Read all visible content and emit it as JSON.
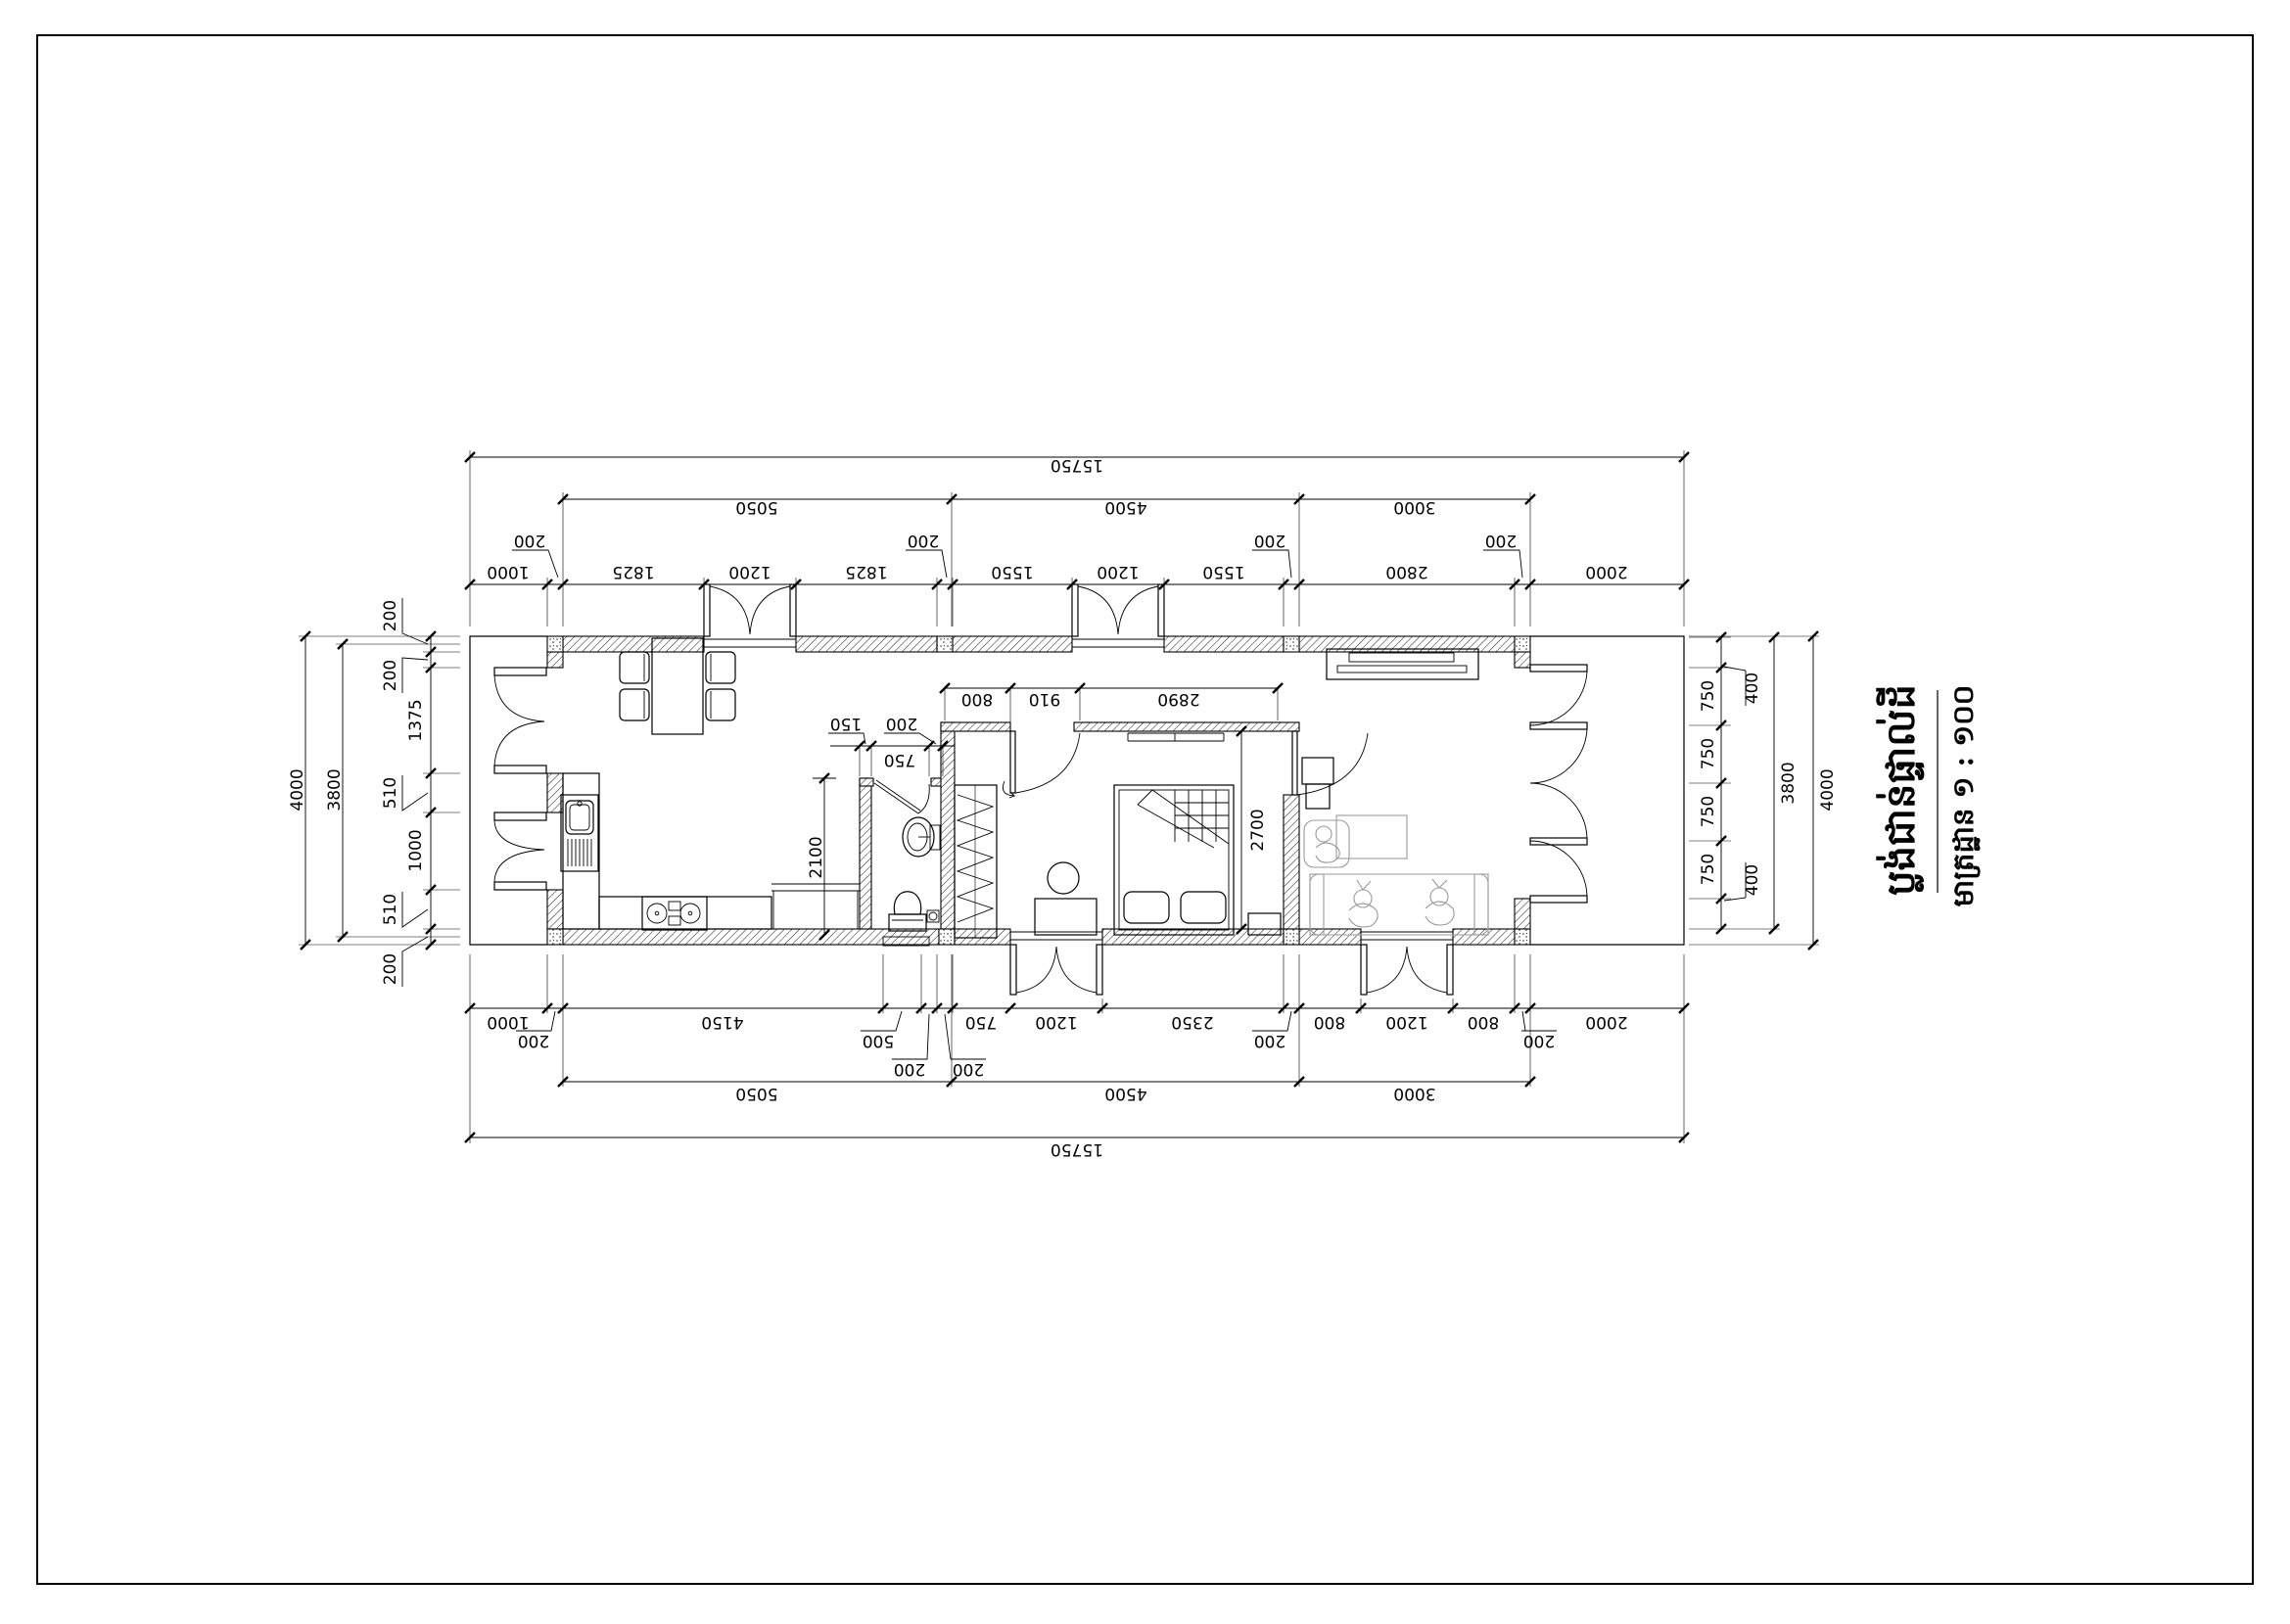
{
  "title": {
    "line1": "ប្លង់ជាន់ផ្ទាល់ដី",
    "line2": "មាត្រដ្ឋាន ១ : ១០០"
  },
  "dims": {
    "top": {
      "total": "15750",
      "spans": [
        "5050",
        "4500",
        "3000"
      ],
      "segments": [
        "1000",
        "1825",
        "1200",
        "1825",
        "1550",
        "1200",
        "1550",
        "2800",
        "2000"
      ],
      "callouts": [
        "200",
        "200",
        "200",
        "200"
      ]
    },
    "bottom": {
      "total": "15750",
      "spans": [
        "5050",
        "4500",
        "3000"
      ],
      "segments": [
        "1000",
        "4150",
        "750",
        "1200",
        "2350",
        "800",
        "1200",
        "800",
        "2000"
      ],
      "callouts": [
        "200",
        "500",
        "200",
        "200",
        "200",
        "200"
      ]
    },
    "left": {
      "overall": "4000",
      "inner": "3800",
      "segments": [
        "200",
        "200",
        "1375",
        "510",
        "1000",
        "510",
        "200"
      ]
    },
    "right": {
      "overall": "4000",
      "inner": "3800",
      "segments": [
        "400",
        "750",
        "750",
        "750",
        "750",
        "400"
      ]
    },
    "interior": {
      "stair_width": "800",
      "bedroom_door": "910",
      "bedroom_width": "2890",
      "bedroom_depth": "2700",
      "bath_opening": "750",
      "bath_wall_left": "150",
      "bath_wall_right": "200",
      "bath_depth": "2100"
    }
  },
  "colors": {
    "line": "#000000",
    "furniture_gray": "#9a9a9a",
    "paper": "#ffffff"
  }
}
